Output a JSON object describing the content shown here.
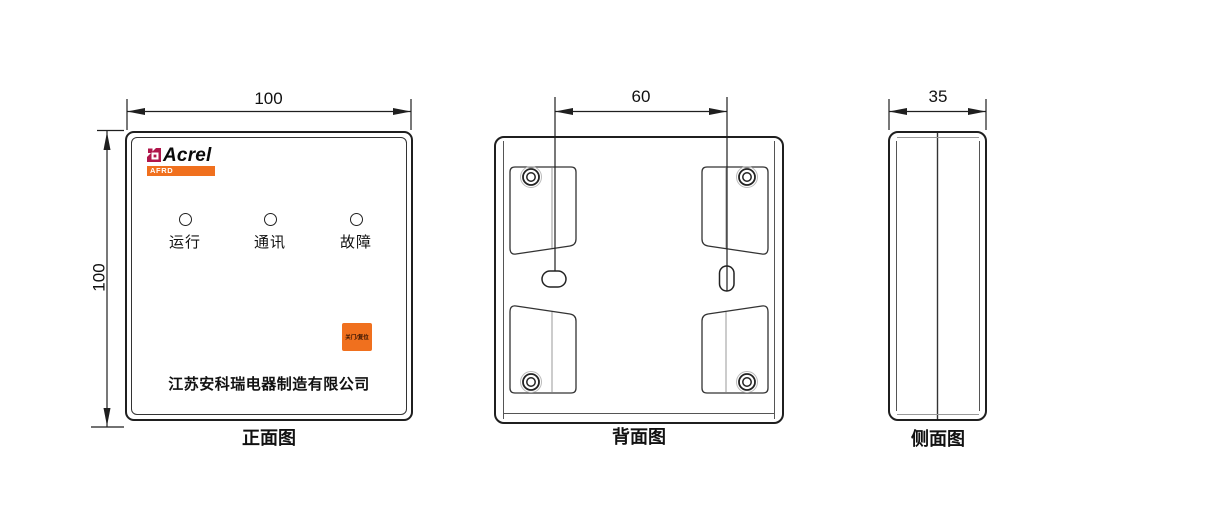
{
  "colors": {
    "accent_orange": "#F0701E",
    "logo_crimson": "#B0164B",
    "line_dark": "#1F1F1F"
  },
  "front_view": {
    "caption": "正面图",
    "width_dim": "100",
    "height_dim": "100",
    "logo": {
      "brand": "Acrel",
      "series": "AFRD"
    },
    "indicators": [
      {
        "label": "运行"
      },
      {
        "label": "通讯"
      },
      {
        "label": "故障"
      }
    ],
    "reset_button_label": "关门/复位",
    "company_name": "江苏安科瑞电器制造有限公司"
  },
  "back_view": {
    "caption": "背面图",
    "hole_spacing_dim": "60"
  },
  "side_view": {
    "caption": "侧面图",
    "depth_dim": "35"
  }
}
